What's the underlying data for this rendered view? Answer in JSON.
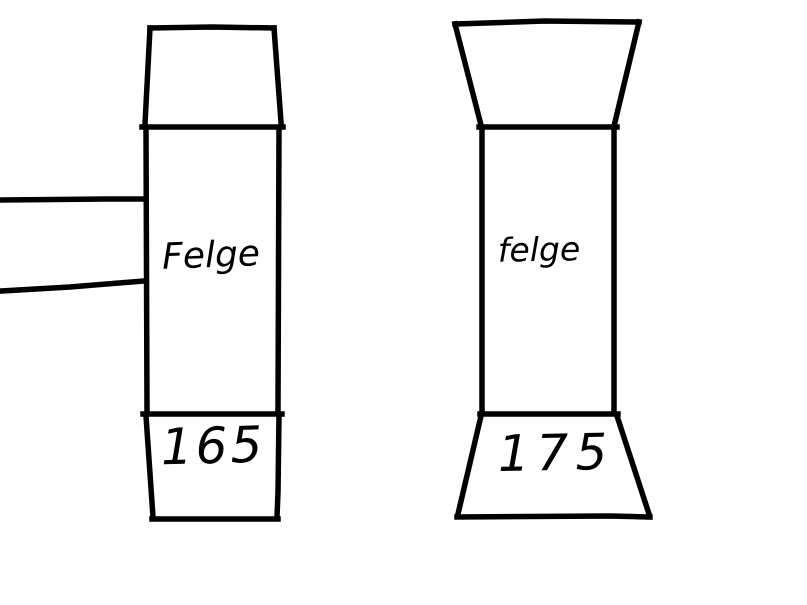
{
  "canvas": {
    "background": "#ffffff",
    "ink": "#000000"
  },
  "left_figure": {
    "rim_label": "Felge",
    "width_label": "165"
  },
  "right_figure": {
    "rim_label": "felge",
    "width_label": "175"
  }
}
